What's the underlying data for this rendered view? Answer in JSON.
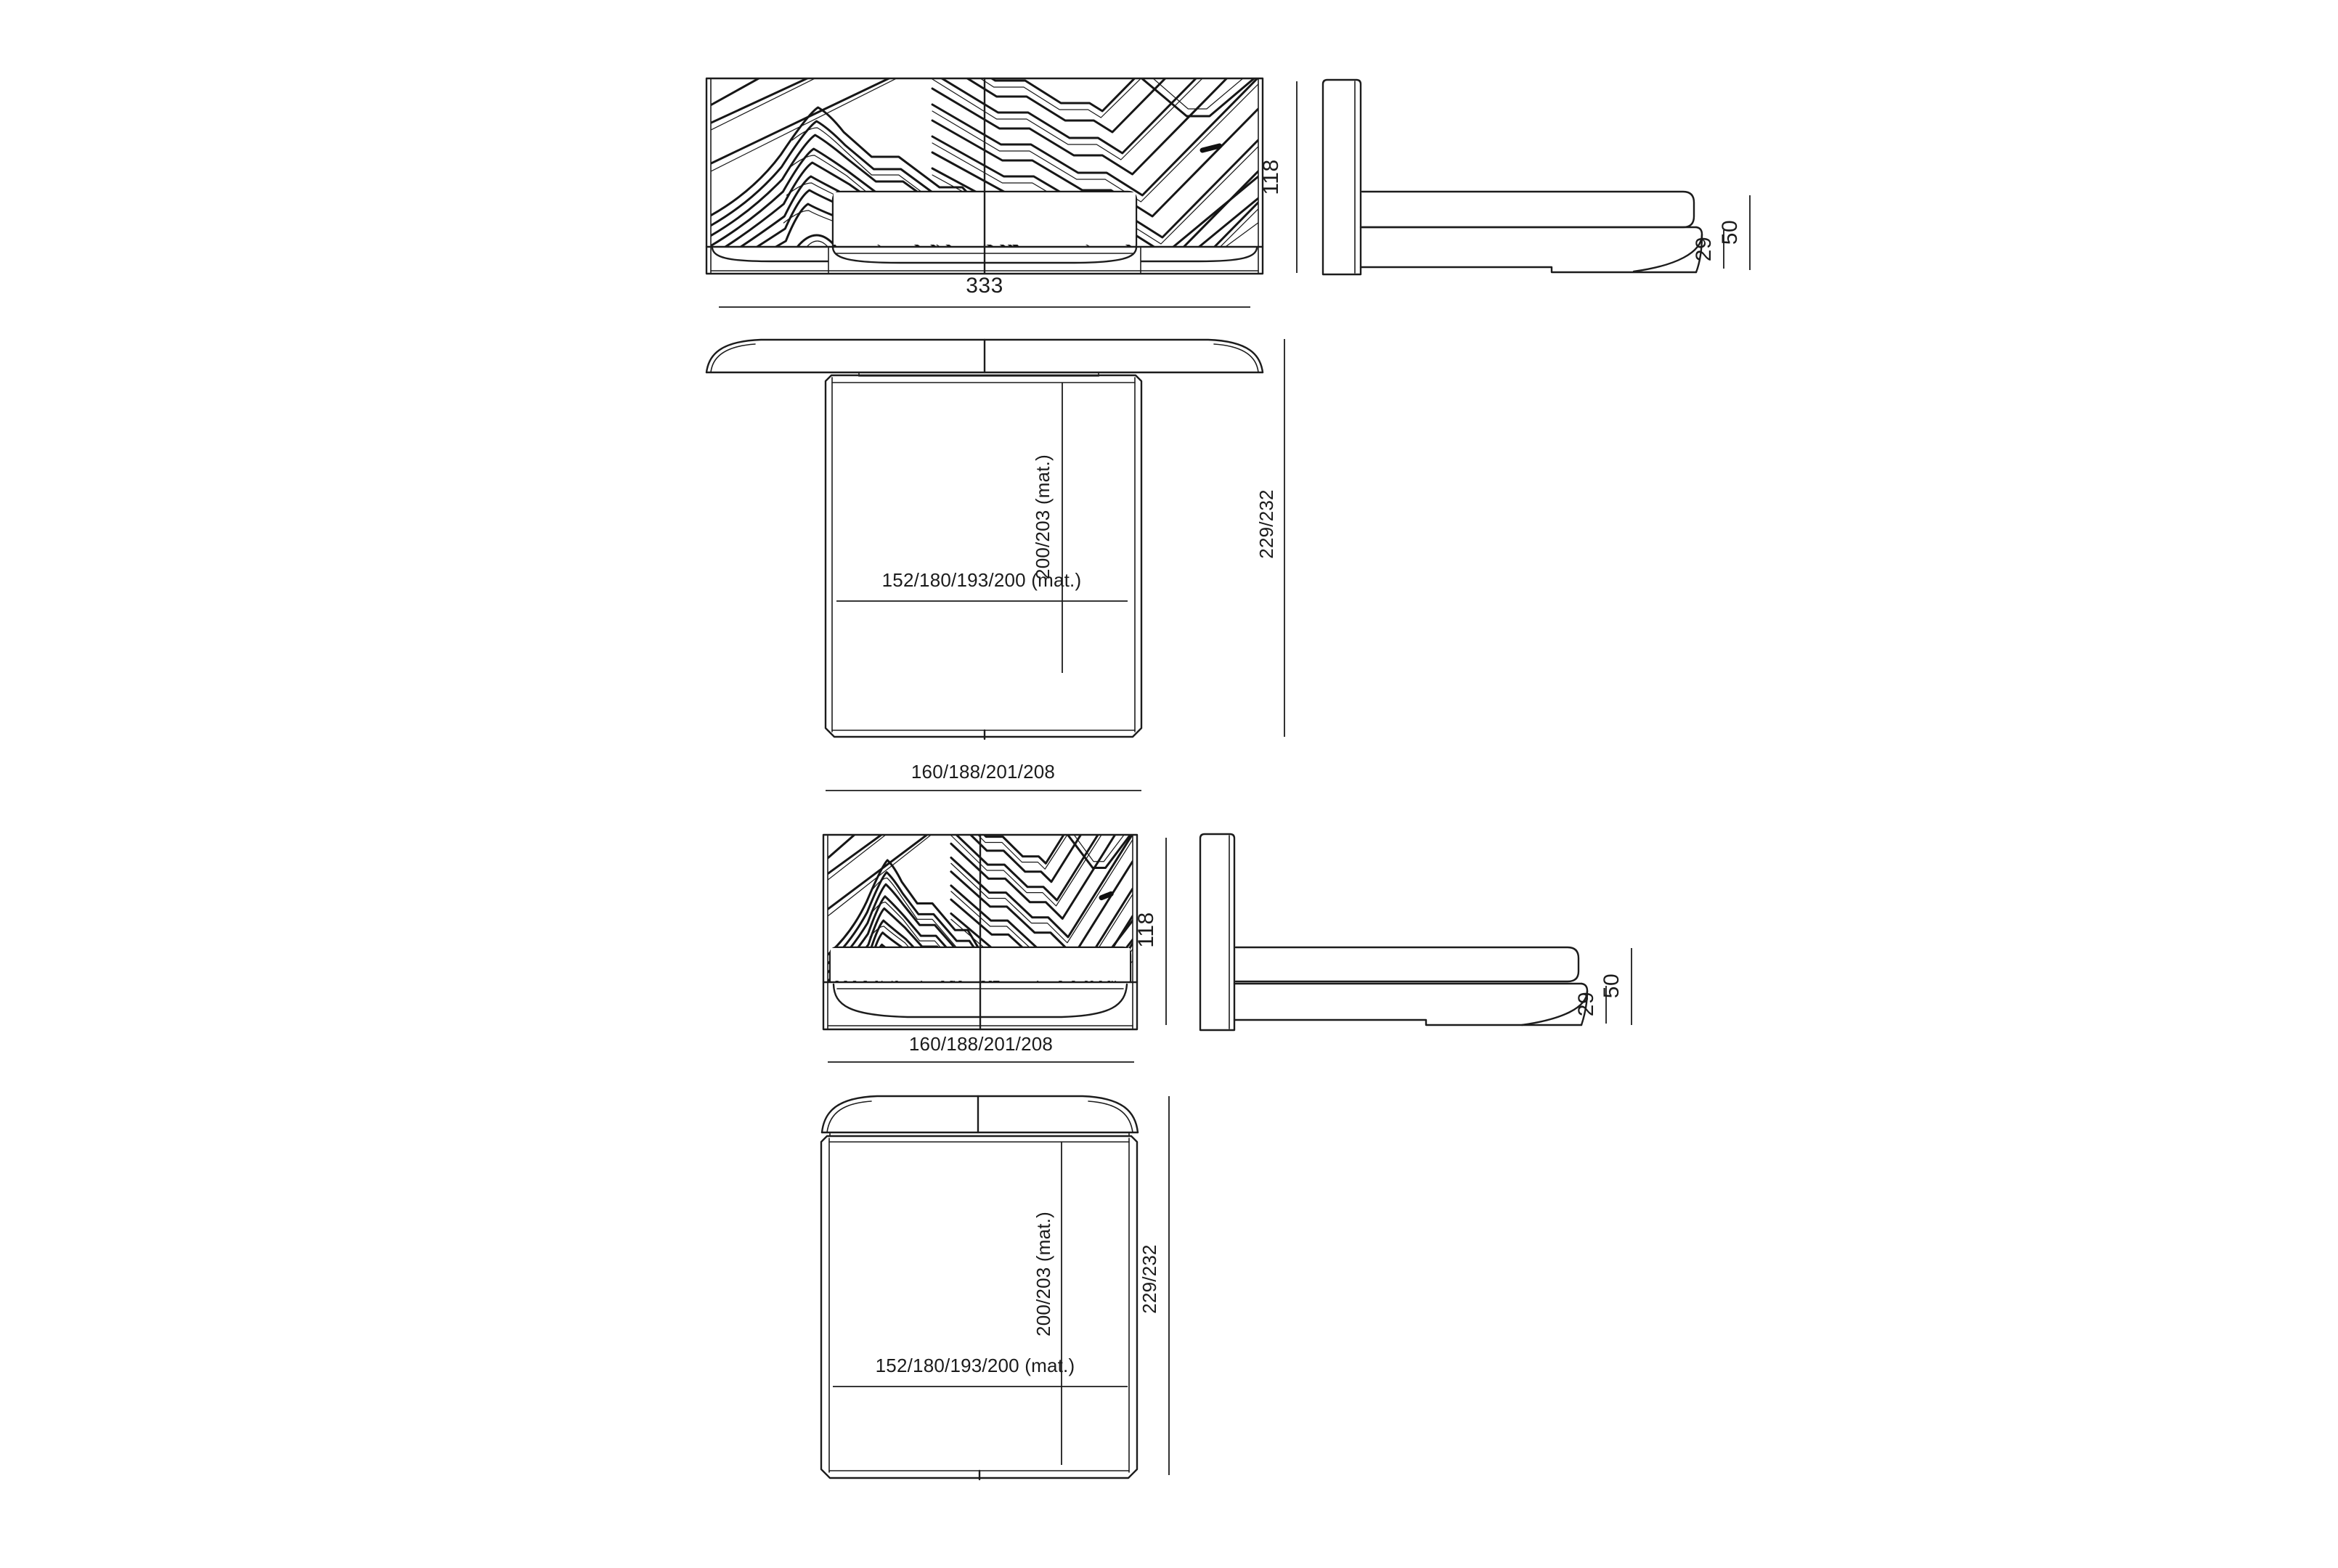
{
  "drawing": {
    "background": "#ffffff",
    "line_color": "#1c1c1c",
    "views": {
      "front_wide": {
        "width": "333",
        "height": "118"
      },
      "side_wide": {
        "platform_height": "29",
        "base_height": "50"
      },
      "plan_wide": {
        "mattress_length": "200/203 (mat.)",
        "mattress_width": "152/180/193/200 (mat.)",
        "overall_depth": "229/232",
        "frame_width": "160/188/201/208"
      },
      "front_compact": {
        "width": "160/188/201/208",
        "height": "118"
      },
      "side_compact": {
        "platform_height": "29",
        "base_height": "50"
      },
      "plan_compact": {
        "mattress_length": "200/203 (mat.)",
        "mattress_width": "152/180/193/200 (mat.)",
        "overall_depth": "229/232"
      }
    }
  }
}
